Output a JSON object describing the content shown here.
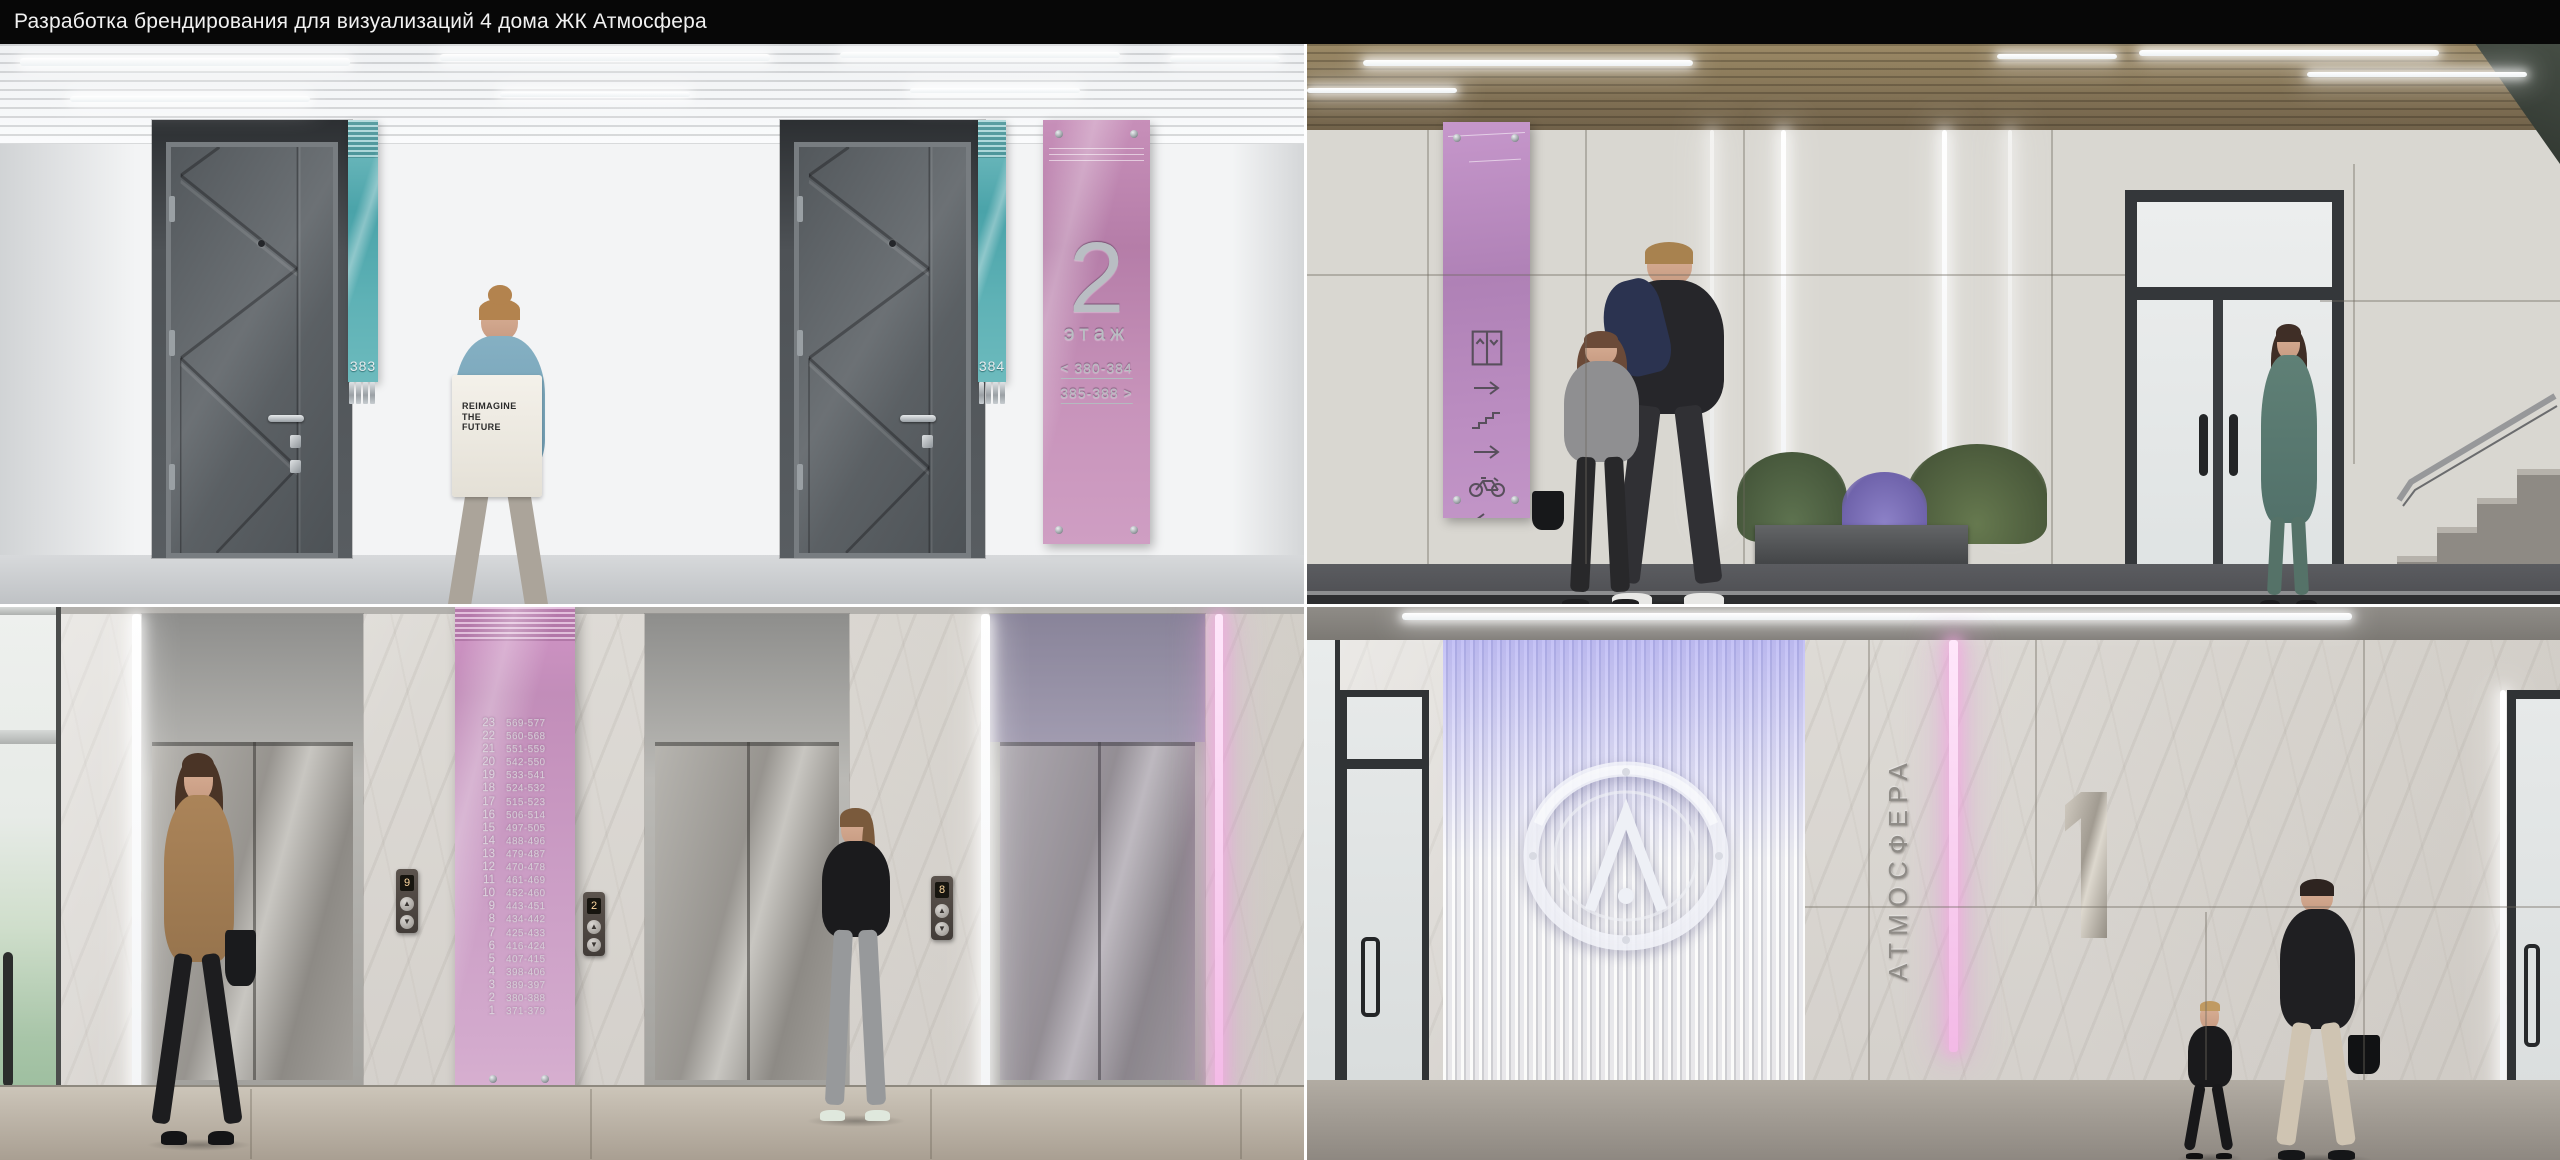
{
  "header": {
    "title": "Разработка брендирования для визуализаций 4 дома ЖК Атмосфера"
  },
  "colors": {
    "title_bar": "#070707",
    "accent_teal": "#54abb0",
    "accent_pink": "#c08fb8",
    "accent_lilac": "#b987c0",
    "signage_metal": "#b9bec3",
    "led_pink": "#f3b9e6"
  },
  "panels": {
    "floor_corridor": {
      "label": "floor-2-corridor-render",
      "apartment_plates": [
        {
          "number": "383"
        },
        {
          "number": "384"
        }
      ],
      "floor_sign": {
        "floor_number": "2",
        "floor_label": "этаж",
        "range_left": "< 380-384",
        "range_right": "385-388 >"
      },
      "tote_bag": {
        "line1": "REIMAGINE",
        "line2": "THE",
        "line3": "FUTURE"
      }
    },
    "lobby_wayfinding": {
      "label": "entrance-lobby-wayfinding-render",
      "sign_icons": [
        "elevator-icon",
        "arrow-right-icon",
        "stairs-icon",
        "arrow-right-icon",
        "bicycle-icon",
        "arrow-left-icon"
      ]
    },
    "elevator_hall": {
      "label": "elevator-hall-render",
      "directory": {
        "floors": [
          {
            "floor": "23",
            "apts": "569-577"
          },
          {
            "floor": "22",
            "apts": "560-568"
          },
          {
            "floor": "21",
            "apts": "551-559"
          },
          {
            "floor": "20",
            "apts": "542-550"
          },
          {
            "floor": "19",
            "apts": "533-541"
          },
          {
            "floor": "18",
            "apts": "524-532"
          },
          {
            "floor": "17",
            "apts": "515-523"
          },
          {
            "floor": "16",
            "apts": "506-514"
          },
          {
            "floor": "15",
            "apts": "497-505"
          },
          {
            "floor": "14",
            "apts": "488-496"
          },
          {
            "floor": "13",
            "apts": "479-487"
          },
          {
            "floor": "12",
            "apts": "470-478"
          },
          {
            "floor": "11",
            "apts": "461-469"
          },
          {
            "floor": "10",
            "apts": "452-460"
          },
          {
            "floor": "9",
            "apts": "443-451"
          },
          {
            "floor": "8",
            "apts": "434-442"
          },
          {
            "floor": "7",
            "apts": "425-433"
          },
          {
            "floor": "6",
            "apts": "416-424"
          },
          {
            "floor": "5",
            "apts": "407-415"
          },
          {
            "floor": "4",
            "apts": "398-406"
          },
          {
            "floor": "3",
            "apts": "389-397"
          },
          {
            "floor": "2",
            "apts": "380-388"
          },
          {
            "floor": "1",
            "apts": "371-379"
          }
        ]
      },
      "call_panels": [
        {
          "indicator": "9"
        },
        {
          "indicator": "2"
        },
        {
          "indicator": "8"
        }
      ],
      "call_panel_icons": [
        "arrow-up-icon",
        "arrow-down-icon"
      ]
    },
    "entrance_lobby": {
      "label": "entrance-number-1-lobby-render",
      "brand_name": "АТМОСФЕРА",
      "entrance_number": "1"
    }
  }
}
